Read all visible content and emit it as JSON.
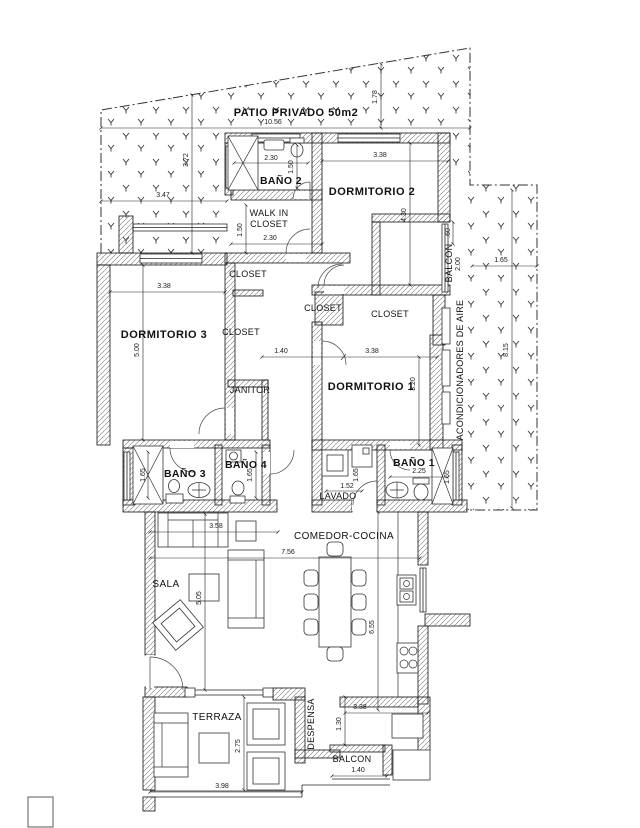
{
  "title": "floor-plan",
  "labels": {
    "patio": "PATIO PRIVADO  50m2",
    "banio2": "BAÑO 2",
    "dorm2": "DORMITORIO 2",
    "walkin1": "WALK IN",
    "walkin2": "CLOSET",
    "closetA": "CLOSET",
    "closetB": "CLOSET",
    "closetC": "CLOSET",
    "closetD": "CLOSET",
    "dorm3": "DORMITORIO 3",
    "janitor": "JANITOR",
    "dorm1": "DORMITORIO 1",
    "banio3": "BAÑO 3",
    "banio4": "BAÑO 4",
    "banio1": "BAÑO 1",
    "lavado": "LAVADO",
    "balcon_top": "BALCON",
    "balcon_bottom": "BALCON",
    "acond": "ACONDICIONADORES DE AIRE",
    "sala": "SALA",
    "comedor": "COMEDOR-COCINA",
    "terraza": "TERRAZA",
    "despensa": "DESPENSA"
  },
  "dims": {
    "d1056": "10.56",
    "d178": "1.78",
    "d347": "3.47",
    "d372": "3.72",
    "d230_b2": "2.30",
    "d150_b2": "1.50",
    "d338_d2": "3.38",
    "d430": "4.30",
    "d150_wc": "1.50",
    "d230_wc": "2.30",
    "d060": ".60",
    "d200": "2.00",
    "d165_pa": "1.65",
    "d815": "8.15",
    "d338_d3": "3.38",
    "d500": "5.00",
    "d140_h": "1.40",
    "d338_d1": "3.38",
    "d320": "3.20",
    "d165_b3": "1.65",
    "d165_b4": "1.65",
    "d152": "1.52",
    "d165_lv": "1.65",
    "d225_b1": "2.25",
    "d165_b1": "1.65",
    "d358": "3.58",
    "d756": "7.56",
    "d505": "5.05",
    "d655": "6.55",
    "d338_co": "3.38",
    "d130": "1.30",
    "d275": "2.75",
    "d398": "3.98",
    "d140_ba": "1.40"
  },
  "colors": {
    "paper": "#ffffff",
    "ink": "#111111",
    "dim": "#222222",
    "hatch": "#777777",
    "grass": "#333333"
  }
}
